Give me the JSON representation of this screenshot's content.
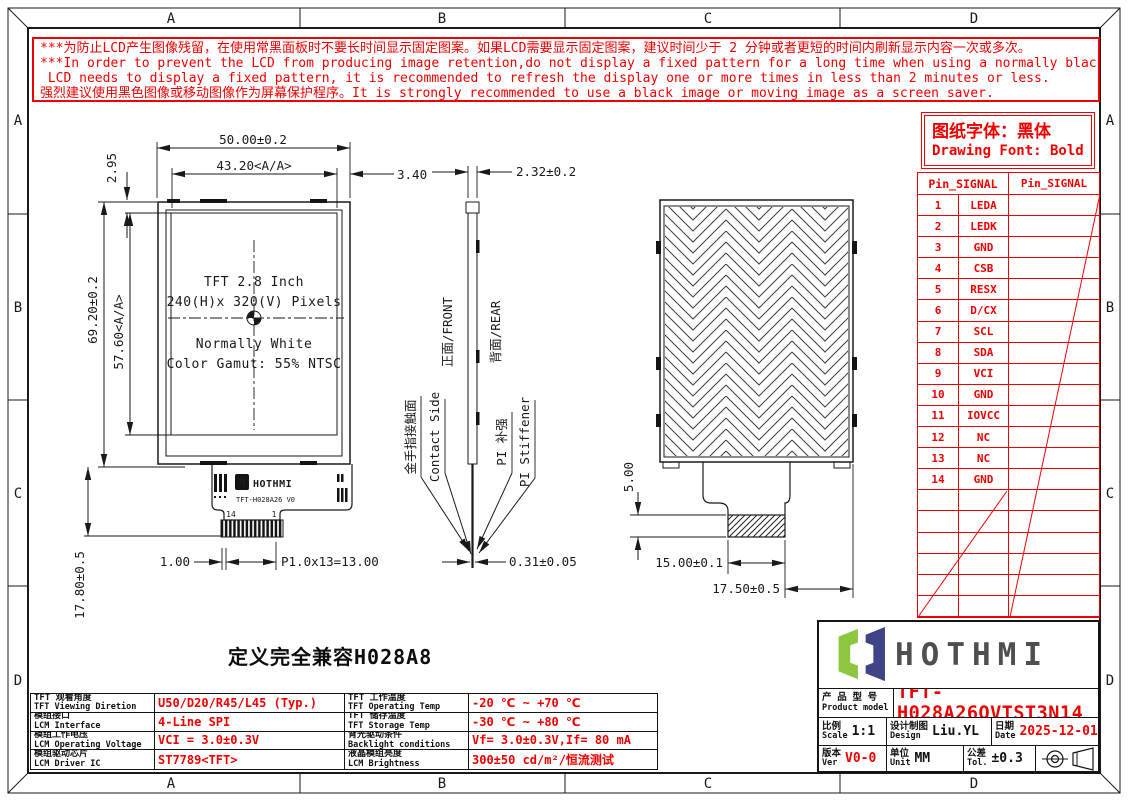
{
  "frame": {
    "zones_top": [
      "A",
      "B",
      "C",
      "D"
    ],
    "zones_bottom": [
      "A",
      "B",
      "C",
      "D"
    ],
    "zones_left": [
      "A",
      "B",
      "C",
      "D"
    ],
    "zones_right": [
      "A",
      "B",
      "C",
      "D"
    ]
  },
  "warning": {
    "lines": [
      "***为防止LCD产生图像残留，在使用常黑面板时不要长时间显示固定图案。如果LCD需要显示固定图案，建议时间少于 2 分钟或者更短的时间内刷新显示内容一次或多次。",
      "***In order to prevent the LCD from producing image retention,do not display a fixed pattern for a long time when using a normally black panel.If the",
      " LCD needs to display a fixed pattern, it is recommended to refresh the display one or more times in less than 2 minutes or less.",
      "强烈建议使用黑色图像或移动图像作为屏幕保护程序。It is strongly recommended to use a black image or moving image as a screen saver."
    ]
  },
  "font_note": {
    "zh": "图纸字体：黑体",
    "en": "Drawing Font: Bold"
  },
  "pin_table": {
    "header_left": "Pin_SIGNAL",
    "header_right": "Pin_SIGNAL",
    "pins": [
      {
        "no": "1",
        "signal": "LEDA"
      },
      {
        "no": "2",
        "signal": "LEDK"
      },
      {
        "no": "3",
        "signal": "GND"
      },
      {
        "no": "4",
        "signal": "CSB"
      },
      {
        "no": "5",
        "signal": "RESX"
      },
      {
        "no": "6",
        "signal": "D/CX"
      },
      {
        "no": "7",
        "signal": "SCL"
      },
      {
        "no": "8",
        "signal": "SDA"
      },
      {
        "no": "9",
        "signal": "VCI"
      },
      {
        "no": "10",
        "signal": "GND"
      },
      {
        "no": "11",
        "signal": "IOVCC"
      },
      {
        "no": "12",
        "signal": "NC"
      },
      {
        "no": "13",
        "signal": "NC"
      },
      {
        "no": "14",
        "signal": "GND"
      }
    ]
  },
  "views": {
    "front": {
      "panel_lines": [
        "TFT 2.8 Inch",
        "240(H)x 320(V) Pixels",
        "Normally White",
        "Color Gamut: 55% NTSC"
      ],
      "fpc_brand": "HOTHMI",
      "fpc_logo_letter": "H",
      "fpc_model": "TFT-H028A26 V0",
      "pin_first": "14",
      "pin_last": "1",
      "dim_width": "50.00±0.2",
      "dim_aa_width": "43.20<A/A>",
      "dim_top_margin": "2.95",
      "dim_right_margin": "3.40",
      "dim_height": "69.20±0.2",
      "dim_aa_height": "57.60<A/A>",
      "dim_tail": "17.80±0.5",
      "dim_pin_margin": "1.00",
      "dim_pitch": "P1.0x13=13.00"
    },
    "side": {
      "dim_thickness": "2.32±0.2",
      "dim_fpc_thickness": "0.31±0.05",
      "label_front": "正面/FRONT",
      "label_rear": "背面/REAR",
      "label_contact_zh": "金手指接触面",
      "label_contact_en": "Contact Side",
      "label_stiffener_zh": "PI 补强",
      "label_stiffener_en": "PI Stiffener"
    },
    "rear": {
      "dim_stiffener_h": "5.00",
      "dim_stiffener_w": "15.00±0.1",
      "dim_tail_w": "17.50±0.5"
    }
  },
  "compat_note": "定义完全兼容H028A8",
  "spec_table": {
    "left": [
      {
        "zh": "TFT 观看角度",
        "en": "TFT Viewing Diretion",
        "value": "U50/D20/R45/L45 (Typ.)"
      },
      {
        "zh": "模组接口",
        "en": "LCM Interface",
        "value": "4-Line SPI"
      },
      {
        "zh": "模组工作电压",
        "en": "LCM Operating Voltage",
        "value": "VCI = 3.0±0.3V"
      },
      {
        "zh": "模组驱动芯片",
        "en": "LCM Driver IC",
        "value": "ST7789<TFT>"
      }
    ],
    "right": [
      {
        "zh": "TFT 工作温度",
        "en": "TFT Operating Temp",
        "value": "-20 ℃ ~ +70 ℃"
      },
      {
        "zh": "TFT 储存温度",
        "en": "TFT Storage Temp",
        "value": "-30 ℃ ~ +80 ℃"
      },
      {
        "zh": "背光驱动条件",
        "en": "Backlight conditions",
        "value": "Vf= 3.0±0.3V,If= 80 mA"
      },
      {
        "zh": "液晶模组亮度",
        "en": "LCM Brightness",
        "value": "300±50  cd/m²/恒流测试"
      }
    ]
  },
  "title_block": {
    "brand": "HOTHMI",
    "model_label_zh": "产 品 型 号",
    "model_label_en": "Product model",
    "model": "TFT-H028A26QVTST3N14",
    "scale_zh": "比例",
    "scale_en": "Scale",
    "scale": "1:1",
    "design_zh": "设计制图",
    "design_en": "Design",
    "designer": "Liu.YL",
    "date_zh": "日期",
    "date_en": "Date",
    "date": "2025-12-01",
    "ver_zh": "版本",
    "ver_en": "Ver",
    "version": "V0-0",
    "unit_zh": "单位",
    "unit_en": "Unit",
    "unit": "MM",
    "tol_zh": "公差",
    "tol_en": "Tol.",
    "tolerance": "±0.3"
  },
  "colors": {
    "red": "#f10000",
    "line": "#1a1a1a",
    "logo_green": "#8dc63f",
    "logo_navy": "#3f4387",
    "logo_text": "#4f4f4f"
  }
}
